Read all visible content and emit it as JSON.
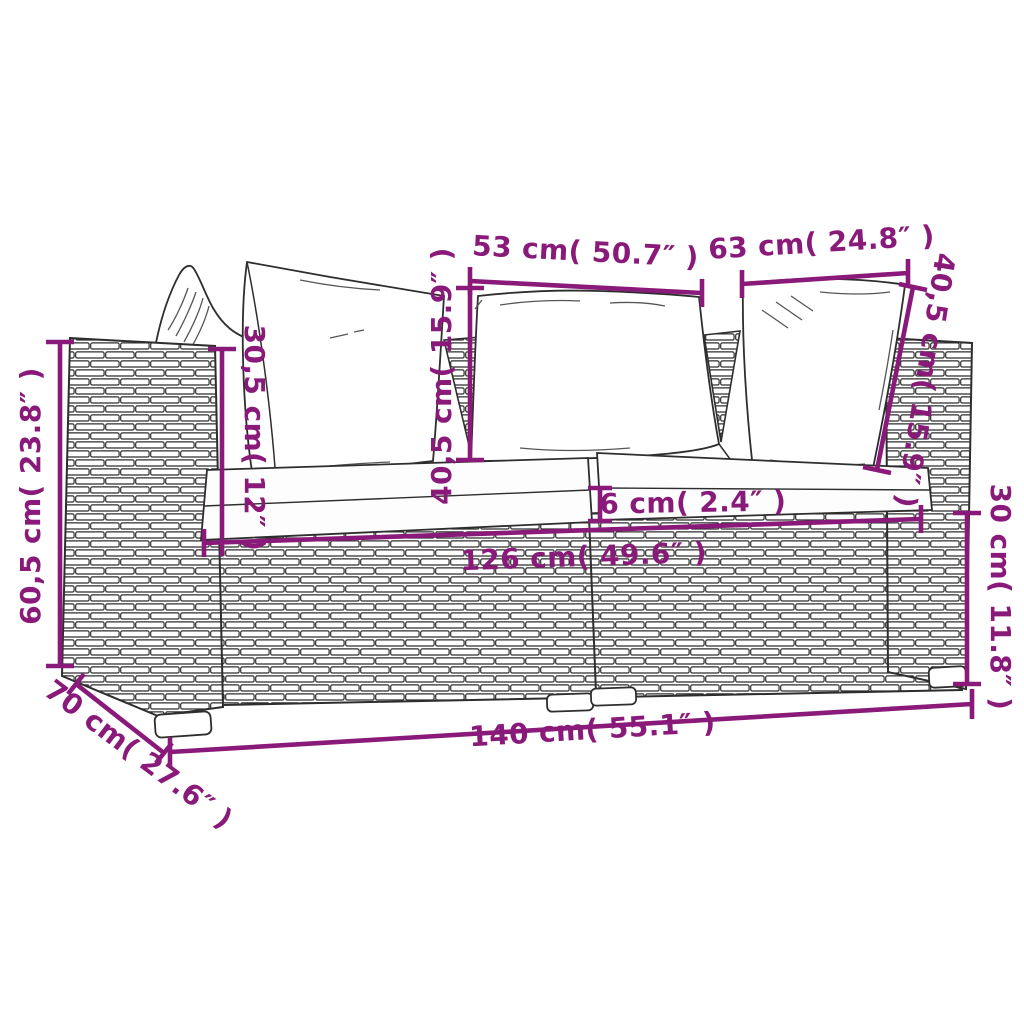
{
  "diagram": {
    "kind": "product-dimensions-diagram",
    "subject": "rattan-2-seater-sofa-with-cushions",
    "colors": {
      "accent": "#8a1a7a",
      "line": "#2e2e2e",
      "background": "#ffffff"
    },
    "dimensions": {
      "back_width_left": "53 cm( 50.7″ )",
      "back_width_right": "63 cm( 24.8″ )",
      "back_cushion_height_center": "40,5 cm( 15.9″ )",
      "back_cushion_height_right": "40,5 cm( 15.9″ )",
      "armrest_above_seat_height": "30,5 cm( 12″ )",
      "overall_height": "60,5 cm( 23.8″ )",
      "seat_cushion_thickness": "6 cm( 2.4″ )",
      "inner_seat_width": "126 cm( 49.6″ )",
      "base_height": "30 cm( 11.8″ )",
      "overall_width": "140 cm( 55.1″ )",
      "overall_depth": "70 cm( 27.6″ )"
    }
  }
}
